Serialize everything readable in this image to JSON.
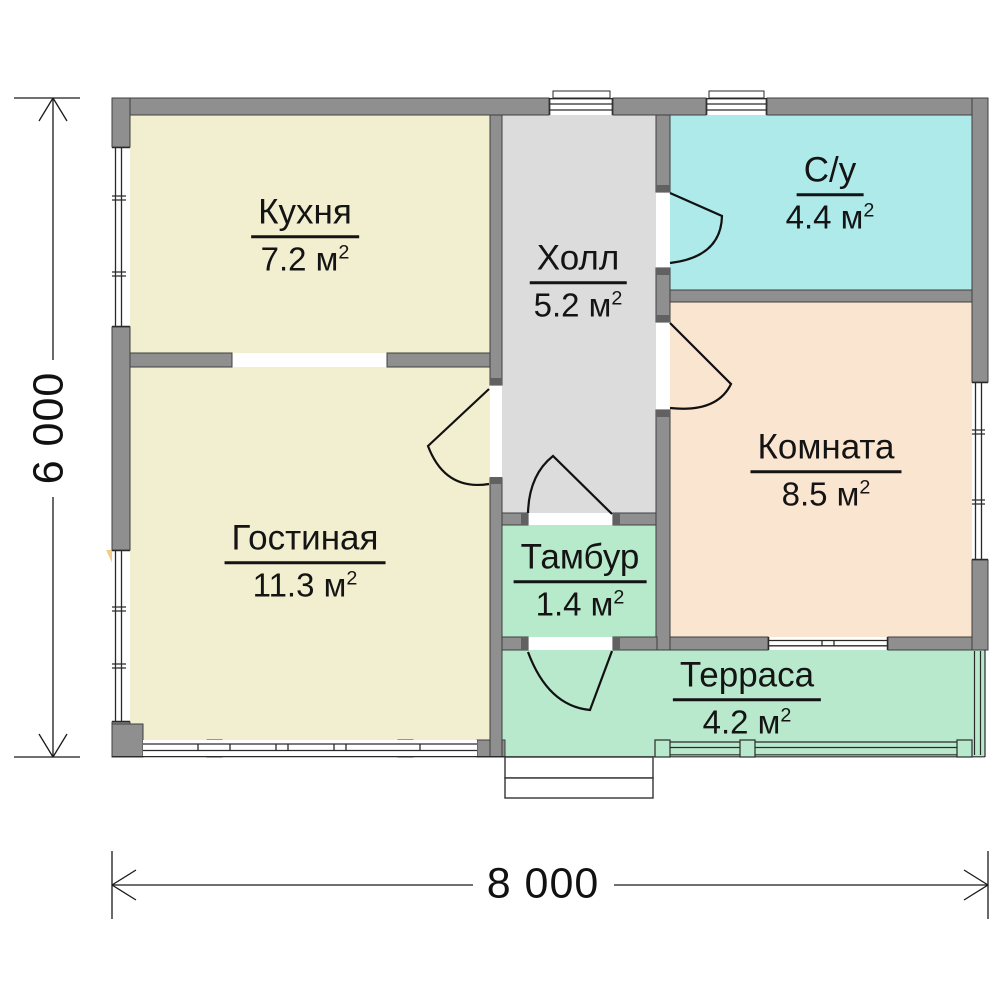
{
  "plan": {
    "rooms": [
      {
        "id": "kitchen",
        "name": "Кухня",
        "area": "7.2 м",
        "exp": "2",
        "color": "#f1efcf"
      },
      {
        "id": "hall",
        "name": "Холл",
        "area": "5.2 м",
        "exp": "2",
        "color": "#dcdcdc"
      },
      {
        "id": "bathroom",
        "name": "С/у",
        "area": "4.4 м",
        "exp": "2",
        "color": "#aeeaea"
      },
      {
        "id": "room",
        "name": "Комната",
        "area": "8.5 м",
        "exp": "2",
        "color": "#fae6d0"
      },
      {
        "id": "living",
        "name": "Гостиная",
        "area": "11.3 м",
        "exp": "2",
        "color": "#f1efcf"
      },
      {
        "id": "tambour",
        "name": "Тамбур",
        "area": "1.4 м",
        "exp": "2",
        "color": "#b7e9cb"
      },
      {
        "id": "terrace",
        "name": "Терраса",
        "area": "4.2 м",
        "exp": "2",
        "color": "#b9e9cd"
      }
    ],
    "dimensions": {
      "width_label": "8 000",
      "height_label": "6 000"
    },
    "colors": {
      "wall": "#8f8f8f",
      "wall_edge": "#3f3f3f",
      "jamb": "#616161",
      "line": "#1a1a1a",
      "marker": "#f0c169"
    }
  }
}
